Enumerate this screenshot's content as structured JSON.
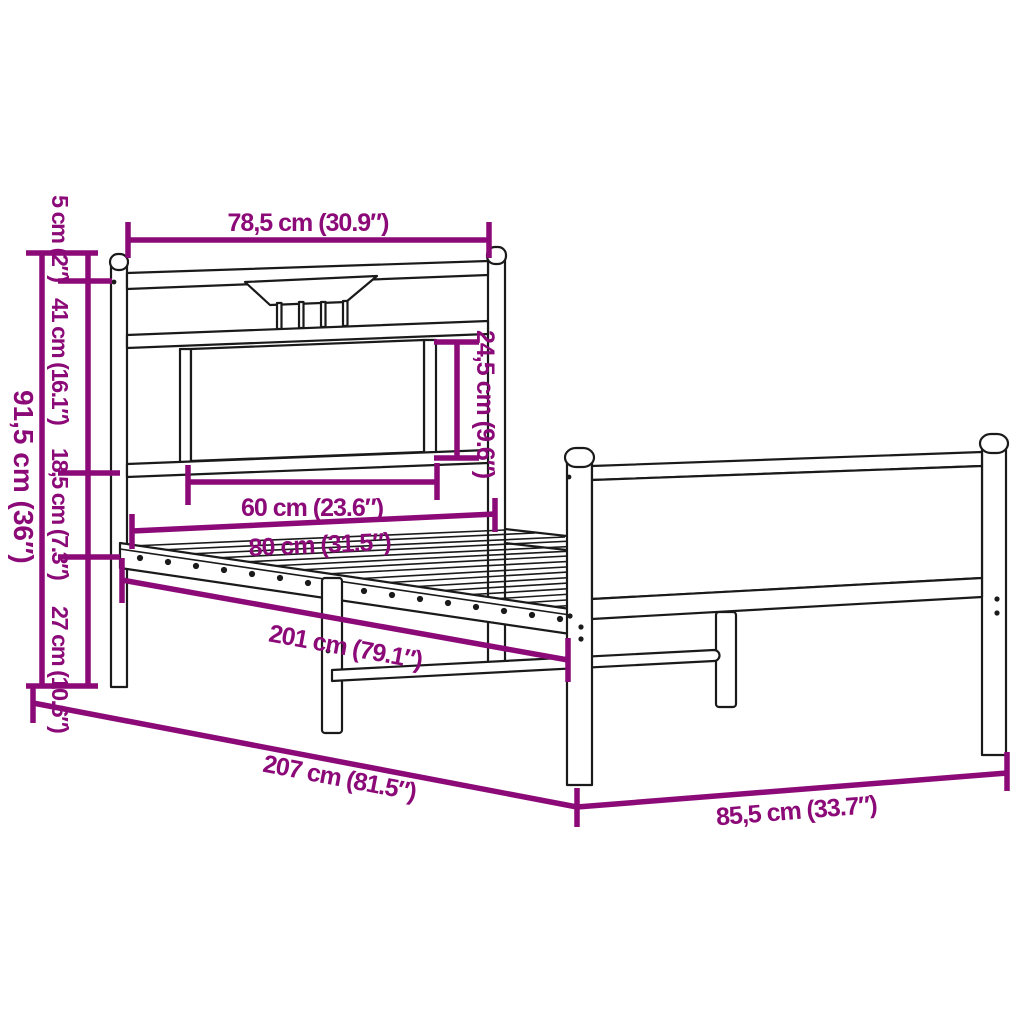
{
  "diagram": {
    "subject": "metal bed frame with headboard and footboard - dimension drawing",
    "accent_color": "#8B0A78",
    "outline_color": "#1a1a1a",
    "background_color": "#ffffff"
  },
  "labels": {
    "headboard_width": "78,5 cm (30.9″)",
    "finial_height": "5 cm (2″)",
    "headboard_upper_height": "41 cm (16.1″)",
    "rail_section_height": "18,5 cm (7.3″)",
    "ground_clearance": "27 cm (10.6″)",
    "headboard_total_height": "91,5 cm (36″)",
    "panel_height": "24,5 cm (9.6″)",
    "panel_width": "60 cm (23.6″)",
    "frame_width": "80 cm (31.5″)",
    "slat_area_length": "201 cm (79.1″)",
    "total_length": "207 cm (81.5″)",
    "footboard_width": "85,5 cm (33.7″)"
  }
}
